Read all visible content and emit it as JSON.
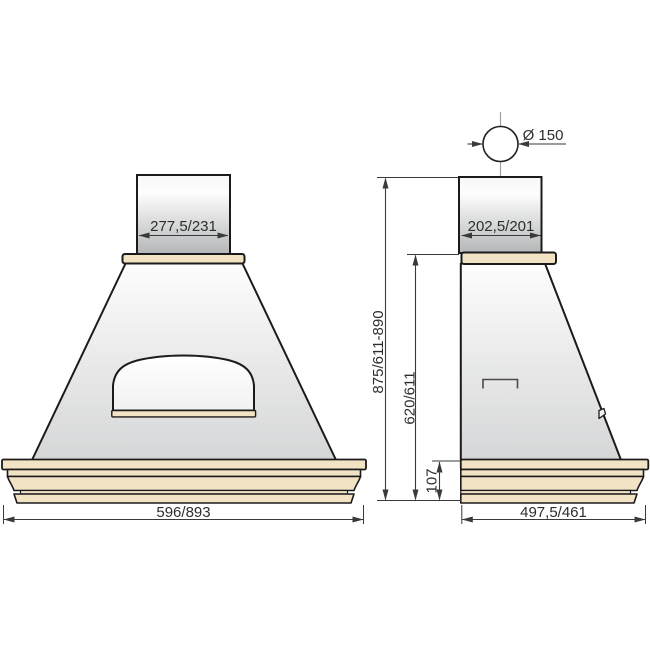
{
  "front_view": {
    "chimney_width_label": "277,5/231",
    "overall_width_label": "596/893"
  },
  "side_view": {
    "duct_diameter_label": "Ø 150",
    "chimney_depth_label": "202,5/201",
    "overall_height_label": "875/611-890",
    "body_height_label": "620/611",
    "base_height_label": "107",
    "overall_depth_label": "497,5/461"
  },
  "colors": {
    "trim_beige": "#f3e3c5",
    "outline": "#1b1b1b",
    "dimension": "#3a3a3a",
    "centerline": "#a0a4a6"
  }
}
